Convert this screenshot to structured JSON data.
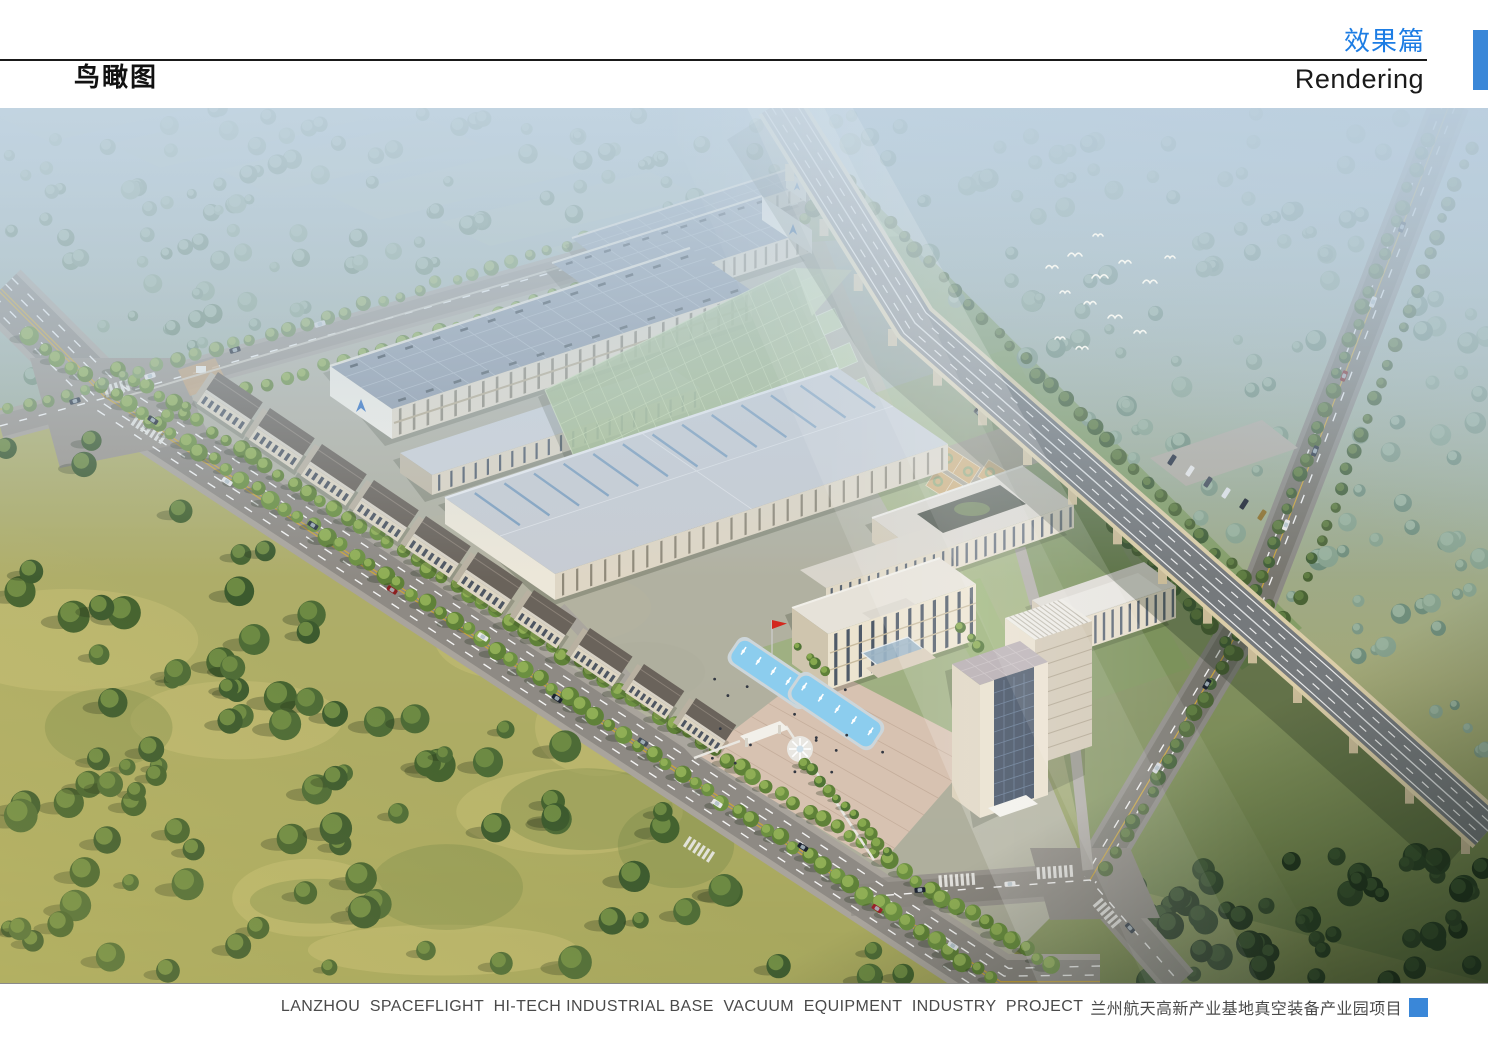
{
  "page": {
    "width": 1488,
    "height": 1052,
    "background": "#ffffff"
  },
  "header": {
    "page_title": "鸟瞰图",
    "section_title_zh": "效果篇",
    "section_title_en": "Rendering",
    "accent_text_color": "#1d7de4",
    "accent_tab_color": "#3a87d8",
    "rule_color": "#1a1a1a"
  },
  "footer": {
    "project_name_en": "LANZHOU  SPACEFLIGHT  HI-TECH INDUSTRIAL BASE  VACUUM  EQUIPMENT  INDUSTRY  PROJECT",
    "project_name_zh": "兰州航天高新产业基地真空装备产业园项目",
    "text_color": "#4a4a4a",
    "accent_square_color": "#3a87d8"
  },
  "rendering": {
    "kind": "aerial bird's-eye architectural rendering",
    "elements": [
      "long factory workshops with skylight roofs and blue logo gables",
      "green glass-clad workshop with sawtooth edge",
      "administration office building with entrance canopy",
      "courtyard research building",
      "high-rise tower with louvered roof",
      "entry plaza with two fountain pools, sculpture and red flag",
      "basketball courts and parking lot",
      "tree-lined avenue with traffic",
      "elevated expressway viaduct on piers",
      "side road under viaduct",
      "yellow-green meadow and hazy forest belts",
      "flock of white birds"
    ]
  }
}
